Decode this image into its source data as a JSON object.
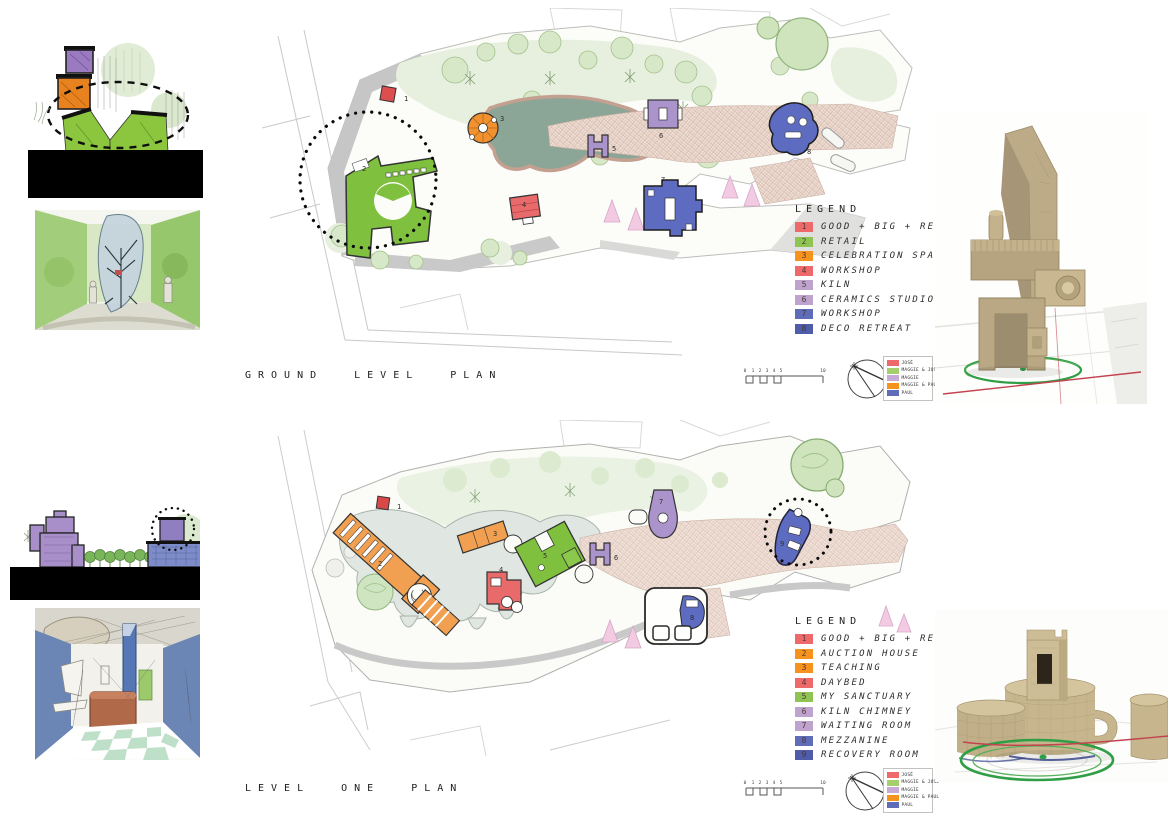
{
  "board": {
    "ground": {
      "title": "GROUND LEVEL PLAN",
      "legend": {
        "heading": "LEGEND",
        "items": [
          {
            "num": "1",
            "label": "GOOD + BIG + RED",
            "color": "#ee6a6a"
          },
          {
            "num": "2",
            "label": "RETAIL",
            "color": "#8fc455"
          },
          {
            "num": "3",
            "label": "CELEBRATION SPACE",
            "color": "#f6921e"
          },
          {
            "num": "4",
            "label": "WORKSHOP",
            "color": "#ee6a6a"
          },
          {
            "num": "5",
            "label": "KILN",
            "color": "#bfa3cf"
          },
          {
            "num": "6",
            "label": "CERAMICS STUDIO",
            "color": "#bfa3cf"
          },
          {
            "num": "7",
            "label": "WORKSHOP",
            "color": "#5f6cb8"
          },
          {
            "num": "8",
            "label": "DECO RETREAT",
            "color": "#4e5ca9"
          }
        ]
      },
      "markers": [
        "1",
        "2",
        "3",
        "4",
        "5",
        "6",
        "7",
        "8"
      ]
    },
    "level_one": {
      "title": "LEVEL ONE PLAN",
      "legend": {
        "heading": "LEGEND",
        "items": [
          {
            "num": "1",
            "label": "GOOD + BIG + RED",
            "color": "#ee6a6a"
          },
          {
            "num": "2",
            "label": "AUCTION HOUSE",
            "color": "#f6921e"
          },
          {
            "num": "3",
            "label": "TEACHING",
            "color": "#f6921e"
          },
          {
            "num": "4",
            "label": "DAYBED",
            "color": "#ee6a6a"
          },
          {
            "num": "5",
            "label": "MY SANCTUARY",
            "color": "#8fc455"
          },
          {
            "num": "6",
            "label": "KILN CHIMNEY",
            "color": "#bfa3cf"
          },
          {
            "num": "7",
            "label": "WAITING ROOM",
            "color": "#bfa3cf"
          },
          {
            "num": "8",
            "label": "MEZZANINE",
            "color": "#5f6cb8"
          },
          {
            "num": "9",
            "label": "RECOVERY ROOM",
            "color": "#4e5ca9"
          }
        ]
      },
      "markers": [
        "1",
        "2",
        "3",
        "4",
        "5",
        "6",
        "7",
        "8",
        "9"
      ]
    },
    "attribution": {
      "items": [
        {
          "label": "JOSÉ",
          "color": "#ee6a6a"
        },
        {
          "label": "MAGGIE & JOSÉ",
          "color": "#a5cf6d"
        },
        {
          "label": "MAGGIE",
          "color": "#c7abd6"
        },
        {
          "label": "MAGGIE & PAUL",
          "color": "#f6921e"
        },
        {
          "label": "PAUL",
          "color": "#5f6cb8"
        }
      ]
    },
    "scale_bar": {
      "ticks": [
        "0",
        "1",
        "2",
        "3",
        "4",
        "5"
      ],
      "end_tick": "10"
    }
  }
}
